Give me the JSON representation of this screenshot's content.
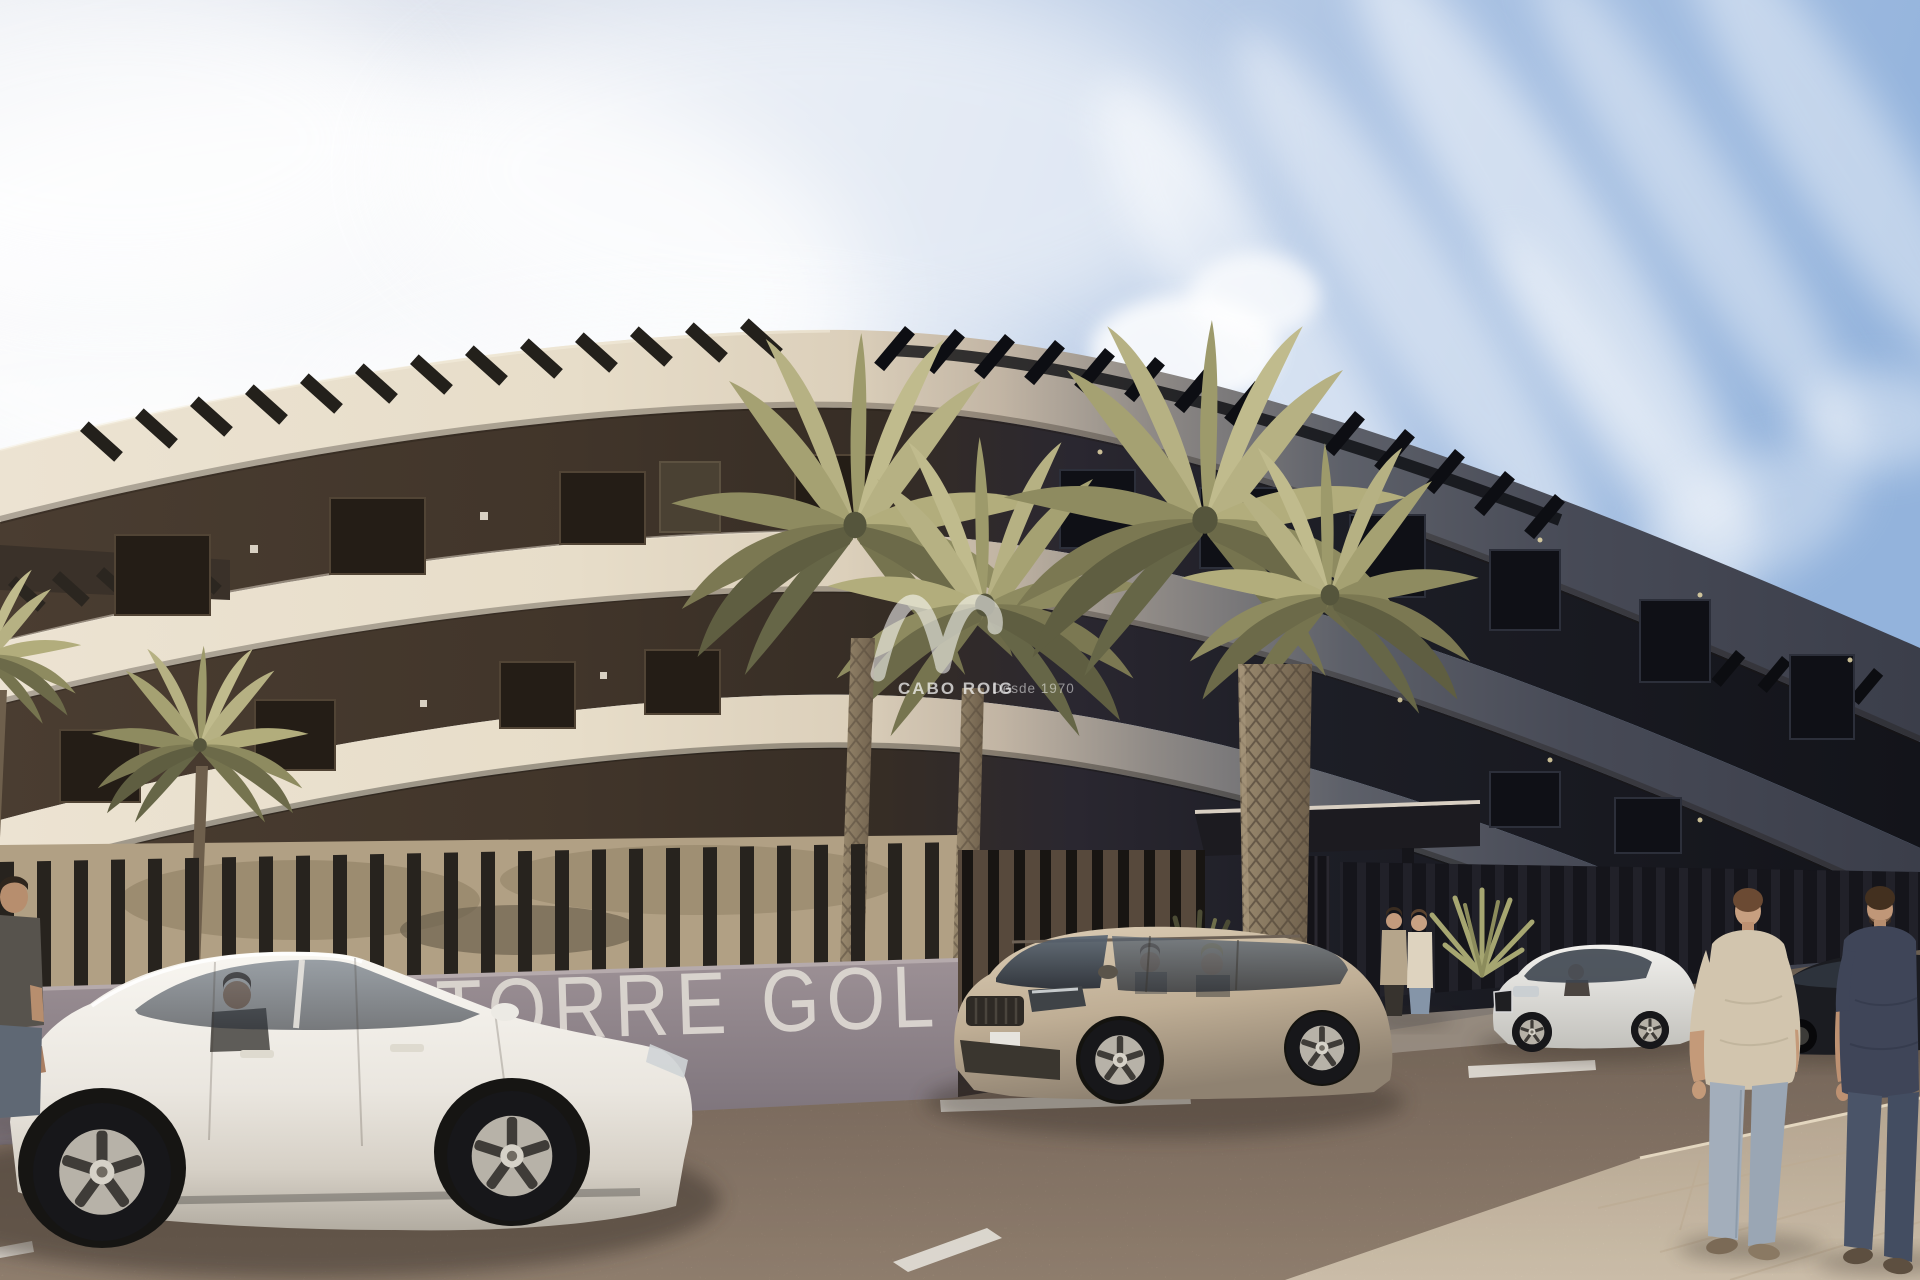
{
  "scene": {
    "description": "Sunlit 3D render of a curved modern apartment building with palm trees, parked cars and pedestrians",
    "signage": {
      "wall_text": "TORRE GOL"
    },
    "watermark": {
      "brand": "CABO ROIG",
      "tagline": "Desde 1970",
      "logo": "AV monogram"
    },
    "palette": {
      "sky_blue": "#93b3dc",
      "sky_haze": "#e8ebf1",
      "facade_light": "#e7ddc9",
      "facade_shadow": "#3b3e4a",
      "recess_dark": "#13141a",
      "wall_mauve": "#8d8189",
      "road": "#a18c7b",
      "sidewalk": "#d5c3ac",
      "palm_lit": "#b2ad7c",
      "palm_shade": "#66654a",
      "sedan_white": "#f1efe9",
      "suv_champagne": "#c6b59e",
      "sedan_silver": "#eceae6",
      "car_dark": "#1b1c21"
    },
    "vehicles": {
      "sedan_white": "white sedan with driver",
      "suv_beige": "champagne SUV with two occupants",
      "sedan_silver": "silver sedan with driver",
      "car_dark": "dark parked car"
    },
    "people": {
      "left_edge": "man standing at left edge",
      "entrance_pair": "two people talking at the entrance",
      "walkers": "two men walking on the sidewalk"
    },
    "vegetation": {
      "palms_tall": "tall palm trees in front of facade",
      "palm_small": "small palm behind the fence",
      "shrubs": "yucca shrubs by the entrance"
    }
  }
}
